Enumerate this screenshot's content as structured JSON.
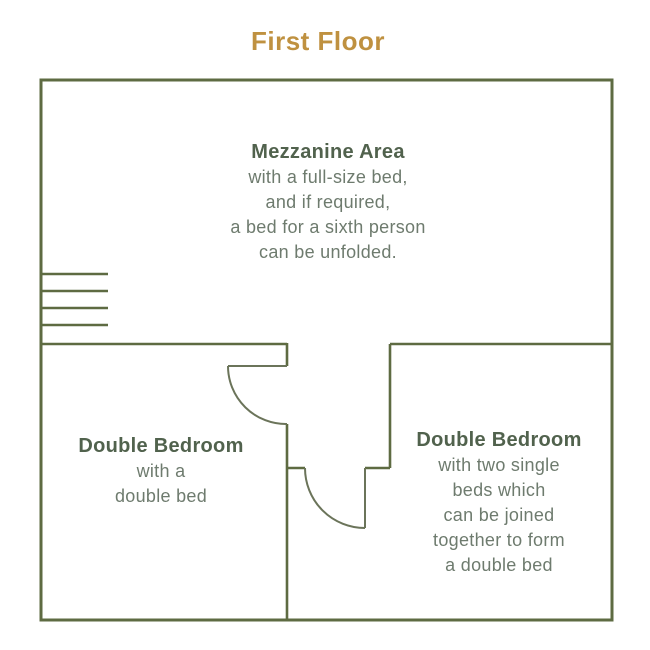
{
  "title": "First Floor",
  "colors": {
    "title": "#bf9140",
    "heading": "#51624d",
    "body": "#6e7b6e",
    "wall": "#5e6b42",
    "door": "#6b745a",
    "background": "#ffffff"
  },
  "rooms": {
    "mezzanine": {
      "name": "Mezzanine Area",
      "lines": [
        "with a full-size bed,",
        "and if required,",
        "a bed for a sixth person",
        "can be unfolded."
      ]
    },
    "bedroom_left": {
      "name": "Double Bedroom",
      "lines": [
        "with a",
        "double bed"
      ]
    },
    "bedroom_right": {
      "name": "Double Bedroom",
      "lines": [
        "with two single",
        "beds which",
        "can be joined",
        "together to form",
        "a double bed"
      ]
    }
  }
}
